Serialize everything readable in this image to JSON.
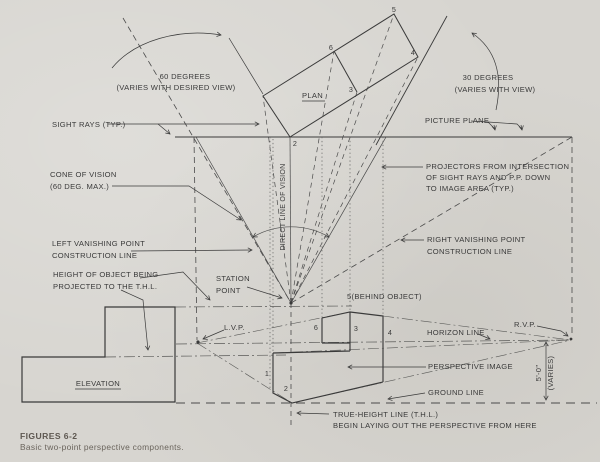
{
  "figure": {
    "caption_title": "FIGURES 6-2",
    "caption_subtitle": "Basic two-point perspective components."
  },
  "colors": {
    "paper": "#d7d5d0",
    "ink": "#3a3a3a"
  },
  "labels": {
    "deg60_line1": "60 DEGREES",
    "deg60_line2": "(VARIES WITH DESIRED VIEW)",
    "deg30_line1": "30 DEGREES",
    "deg30_line2": "(VARIES WITH VIEW)",
    "plan": "PLAN",
    "sight_rays": "SIGHT RAYS (TYP.)",
    "picture_plane": "PICTURE PLANE",
    "cone_line1": "CONE OF VISION",
    "cone_line2": "(60 DEG. MAX.)",
    "projectors_line1": "PROJECTORS FROM INTERSECTION",
    "projectors_line2": "OF SIGHT RAYS AND P.P. DOWN",
    "projectors_line3": "TO IMAGE AREA (TYP.)",
    "lvp_constr_line1": "LEFT VANISHING POINT",
    "lvp_constr_line2": "CONSTRUCTION LINE",
    "rvp_constr_line1": "RIGHT VANISHING POINT",
    "rvp_constr_line2": "CONSTRUCTION LINE",
    "height_line1": "HEIGHT OF OBJECT BEING",
    "height_line2": "PROJECTED TO THE T.H.L.",
    "station_line1": "STATION",
    "station_line2": "POINT",
    "direction_of_vision": "DIRECT LINE OF VISION",
    "behind_object": "5(BEHIND OBJECT)",
    "lvp": "L.V.P.",
    "rvp": "R.V.P.",
    "horizon_line": "HORIZON LINE",
    "perspective_image": "PERSPECTIVE IMAGE",
    "elevation": "ELEVATION",
    "ground_line": "GROUND LINE",
    "thl_line1": "TRUE-HEIGHT LINE (T.H.L.)",
    "thl_line2": "BEGIN LAYING OUT THE PERSPECTIVE FROM HERE",
    "dim_height": "5'-0\"",
    "dim_varies": "(VARIES)"
  },
  "point_numbers": {
    "plan_5": "5",
    "plan_6": "6",
    "plan_3": "3",
    "plan_4": "4",
    "pp_2": "2",
    "img_6": "6",
    "img_3": "3",
    "img_4": "4",
    "img_1": "1",
    "img_2": "2"
  }
}
